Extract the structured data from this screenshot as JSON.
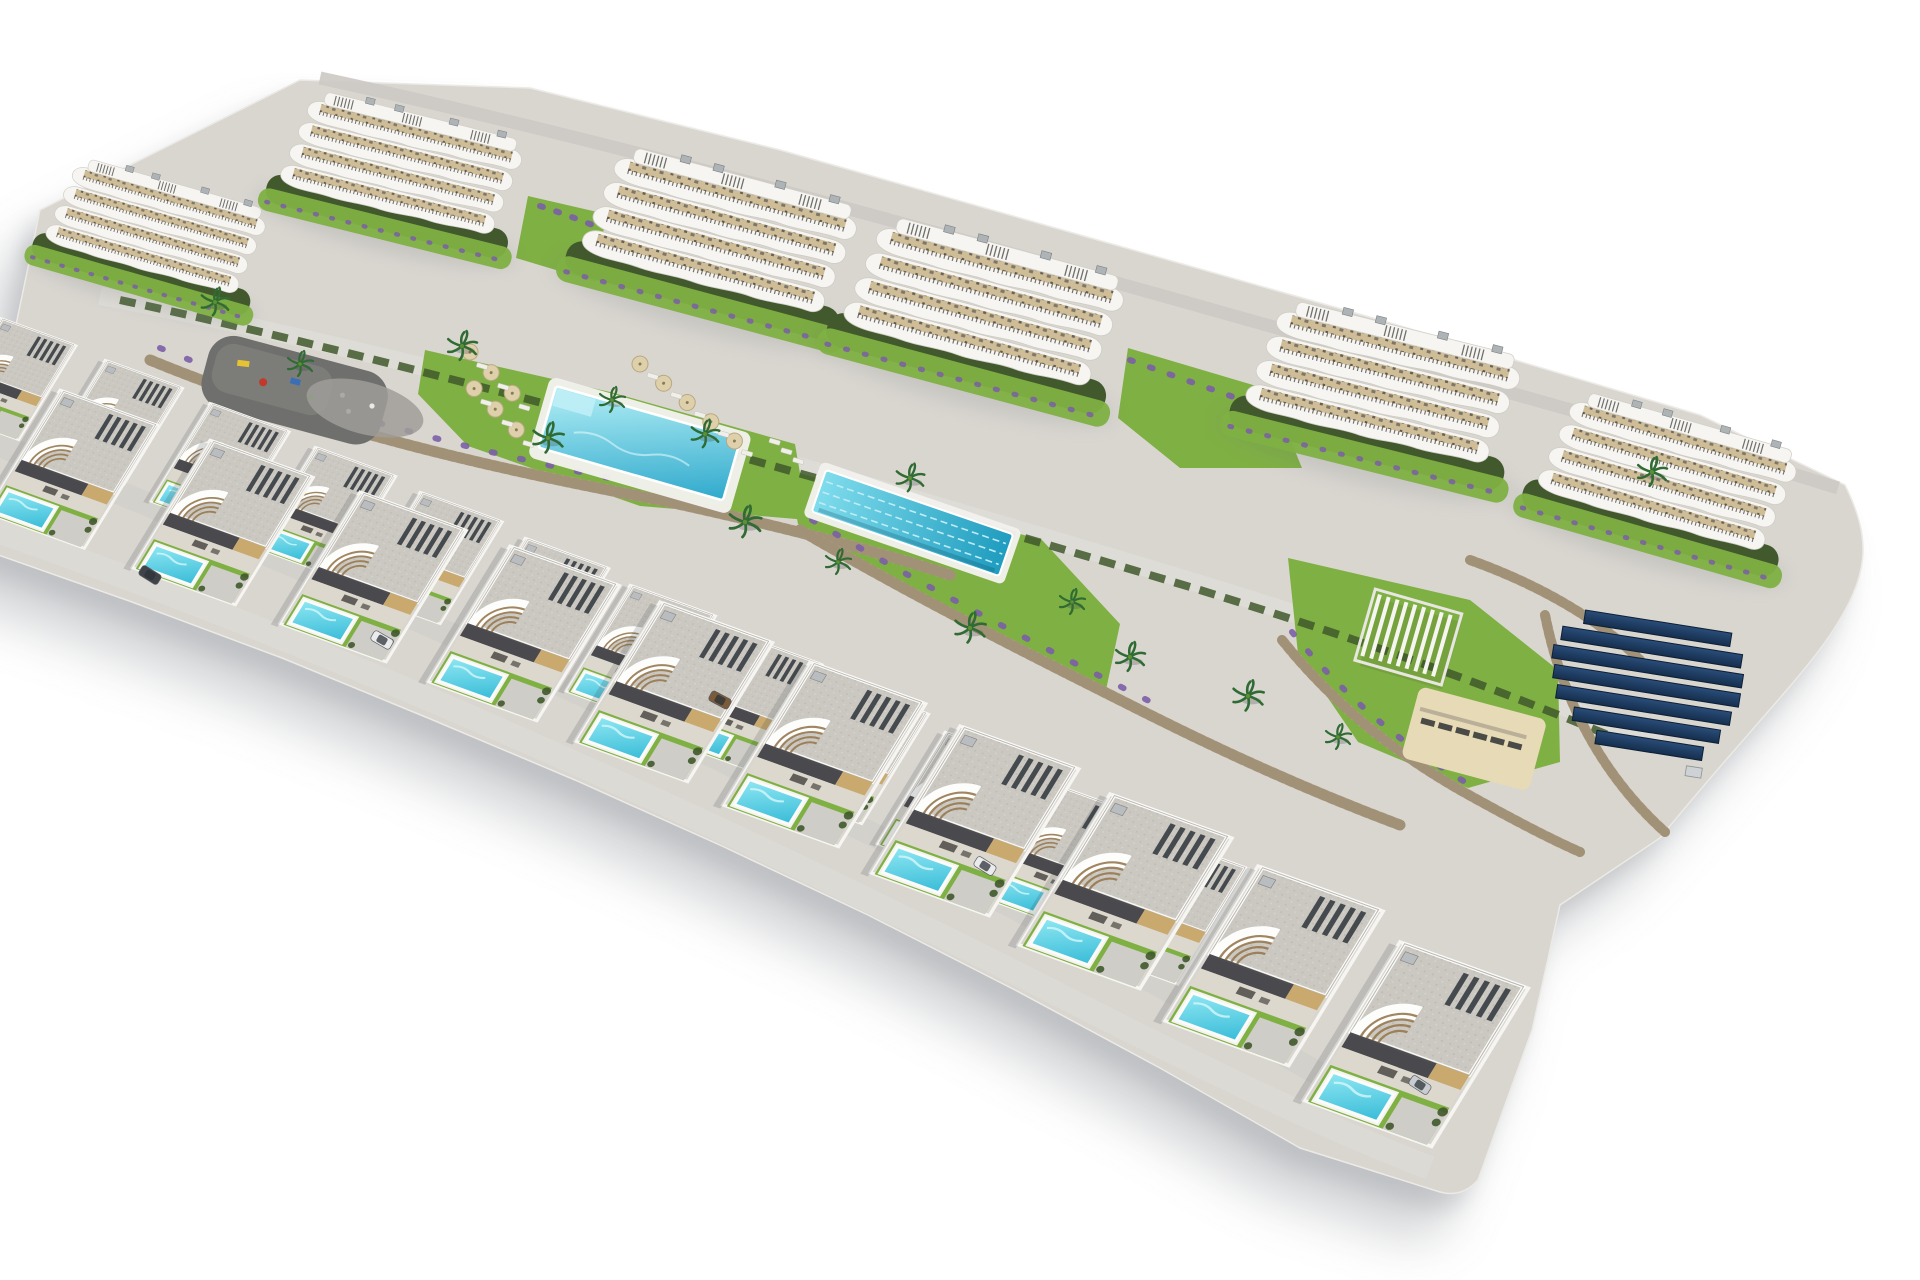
{
  "scene": {
    "title": "Aerial 3D architectural render of a hillside residential resort",
    "description": "Computer-generated bird's-eye rendering, on a plain white background, of a terraced coastal residential development: six white apartment blocks with curved wrap-around balconies and rooftop pergolas along the upper terrace; landscaped communal grounds with a large swimming pool ringed by parasols and sun loungers, a long lap pool, a children's playground, lavender beds, palm trees and dry-stone retaining walls; a pergola sun deck, a sand lounging area and a field of dark solar panels on the right terrace; and two stepped rows of modern white villas in the foreground, each with a grey gravel roof, rooftop solar slats, a curved stair feature, a private lawn and a turquoise plunge pool; a few cars are parked on the internal lanes and driveways.",
    "style": "photorealistic 3D visualisation, high oblique viewpoint, bright midday sun, cutout on white with soft drop shadow",
    "background": "#ffffff",
    "inventory": {
      "apartment_blocks": 6,
      "villas": 23,
      "private_villa_pools": 23,
      "communal_pools": 2,
      "lap_pools": 1,
      "playgrounds": 1,
      "pergola_decks": 1,
      "sand_lounge_areas": 1,
      "solar_panel_arrays": 1,
      "solar_panel_rows": 7,
      "parked_cars": 5,
      "palm_trees": 16,
      "parasols": 11,
      "sun_loungers": 20,
      "stone_retaining_walls": 5
    },
    "palette": {
      "paper": "#ffffff",
      "paving": "#d9d6d0",
      "road": "#ccc9c3",
      "white_wall": "#f6f5f1",
      "roof_gravel": "#cbc8c1",
      "tan_wall": "#c9a96e",
      "porch_shadow": "#35363a",
      "terrace_tan": "#cbb78f",
      "lawn": "#7fb043",
      "hedge": "#41592c",
      "stone": "#b5a68b",
      "stone_dark": "#8f8066",
      "play_paving": "#6f6f6d",
      "lavender": "#7b5ea7",
      "sand": "#e7dab6",
      "shadow": "#8e9297",
      "pool_light": "#8fe7f2",
      "pool_deep": "#38bcd8",
      "bigpool_light": "#b5f0f6",
      "bigpool_deep": "#2fa9cc",
      "lap_light": "#7fdcec",
      "lap_deep": "#1f9cbf",
      "solar_light": "#2a4d79",
      "solar_deep": "#152e4d",
      "car_white": "#e9ebed",
      "car_dark": "#3f444a",
      "car_brown": "#7a5b3a",
      "car_silver": "#c9cdd1",
      "palm": "#2f6b33",
      "furniture": "#4c4a46"
    }
  }
}
